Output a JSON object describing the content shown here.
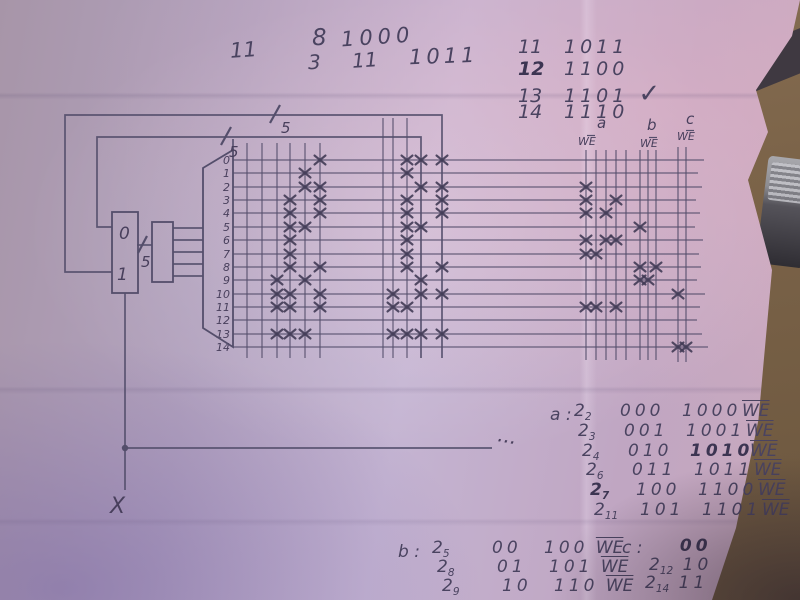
{
  "we_label": "WE",
  "colors": {
    "paper_light": "#c4b4d2",
    "paper_mid": "#b2a2be",
    "paper_dark": "#a795a8",
    "paper_pink": "#caa9bd",
    "ink": "#4a4360",
    "pencil_line": "#585273",
    "table_wood": "#7c6449",
    "corner_shadow": "#3f3941"
  },
  "notes_top": [
    {
      "s": "11",
      "x": 230,
      "y": 40,
      "size": 21
    },
    {
      "s": "8",
      "x": 312,
      "y": 27,
      "size": 23
    },
    {
      "s": "1000",
      "x": 341,
      "y": 27,
      "size": 21,
      "sp": 5
    },
    {
      "s": "3",
      "x": 308,
      "y": 52,
      "size": 20
    },
    {
      "s": "11",
      "x": 352,
      "y": 50,
      "size": 20
    },
    {
      "s": "1011",
      "x": 409,
      "y": 46,
      "size": 21,
      "sp": 4
    }
  ],
  "checklist": {
    "x": 518,
    "y": 38,
    "row_h": 21.5,
    "size": 19,
    "rows": [
      {
        "n": "11",
        "bits": "1011",
        "bold": false,
        "check": false
      },
      {
        "n": "12",
        "bits": "1100",
        "bold": true,
        "check": false
      },
      {
        "n": "13",
        "bits": "1101",
        "bold": false,
        "check": true
      },
      {
        "n": "14",
        "bits": "1110",
        "bold": false,
        "check": false
      }
    ],
    "check_glyph": "✓"
  },
  "table_a": {
    "label": "a :",
    "x": 550,
    "y": 403,
    "row_h": 19.8,
    "drift": 4,
    "size": 17,
    "col_z": 24,
    "col_bits": 70,
    "col_out": 132,
    "col_we": 192,
    "rows": [
      {
        "z": "2",
        "sub": "2",
        "bits": "000",
        "out": "1000",
        "bold_z": false,
        "bold_out": false
      },
      {
        "z": "2",
        "sub": "3",
        "bits": "001",
        "out": "1001",
        "bold_z": false,
        "bold_out": false
      },
      {
        "z": "2",
        "sub": "4",
        "bits": "010",
        "out": "1010",
        "bold_z": false,
        "bold_out": true
      },
      {
        "z": "2",
        "sub": "6",
        "bits": "011",
        "out": "1011",
        "bold_z": false,
        "bold_out": false
      },
      {
        "z": "2",
        "sub": "7",
        "bits": "100",
        "out": "1100",
        "bold_z": true,
        "bold_out": false
      },
      {
        "z": "2",
        "sub": "11",
        "bits": "101",
        "out": "1101",
        "bold_z": false,
        "bold_out": false
      }
    ]
  },
  "table_b": {
    "label": "b :",
    "x": 398,
    "y": 540,
    "row_h": 19,
    "drift": 5,
    "size": 17,
    "col_z": 34,
    "col_bits": 94,
    "col_out": 146,
    "rows": [
      {
        "z": "2",
        "sub": "5",
        "bits": "00",
        "out": "100"
      },
      {
        "z": "2",
        "sub": "8",
        "bits": "01",
        "out": "101"
      },
      {
        "z": "2",
        "sub": "9",
        "bits": "10",
        "out": "110"
      }
    ]
  },
  "table_c": {
    "label": "c :",
    "x": 622,
    "y": 538,
    "size": 17,
    "rows": [
      {
        "z": "",
        "sub": "",
        "bits": "00",
        "dx": 48,
        "dy": 0,
        "bold": true
      },
      {
        "z": "2",
        "sub": "12",
        "bits": "10",
        "dx": 27,
        "dy": 19,
        "bold": false
      },
      {
        "z": "2",
        "sub": "14",
        "bits": "11",
        "dx": 23,
        "dy": 37,
        "bold": false
      }
    ]
  },
  "diagram": {
    "stroke": "#544e6b",
    "row_x1": 233,
    "label_x": 230,
    "rows": [
      {
        "label": "0",
        "y": 160,
        "x2": 704
      },
      {
        "label": "1",
        "y": 173,
        "x2": 698
      },
      {
        "label": "2",
        "y": 187,
        "x2": 702
      },
      {
        "label": "3",
        "y": 200,
        "x2": 696
      },
      {
        "label": "4",
        "y": 213,
        "x2": 700
      },
      {
        "label": "5",
        "y": 227,
        "x2": 695
      },
      {
        "label": "6",
        "y": 240,
        "x2": 703
      },
      {
        "label": "7",
        "y": 254,
        "x2": 699
      },
      {
        "label": "8",
        "y": 267,
        "x2": 701
      },
      {
        "label": "9",
        "y": 280,
        "x2": 697
      },
      {
        "label": "10",
        "y": 294,
        "x2": 705
      },
      {
        "label": "11",
        "y": 307,
        "x2": 700
      },
      {
        "label": "12",
        "y": 320,
        "x2": 697
      },
      {
        "label": "13",
        "y": 334,
        "x2": 702
      },
      {
        "label": "14",
        "y": 347,
        "x2": 708
      }
    ],
    "col_groups": [
      {
        "name": "matrix-left",
        "xs": [
          247,
          262,
          277,
          290,
          305,
          320
        ],
        "y1": 143,
        "y2": 358
      },
      {
        "name": "matrix-mid",
        "xs": [
          383,
          393,
          407
        ],
        "y1": 118,
        "y2": 358
      },
      {
        "name": "bank-a",
        "xs": [
          586,
          596,
          606,
          616,
          626
        ],
        "y1": 150,
        "y2": 360
      },
      {
        "name": "bank-b",
        "xs": [
          640,
          648,
          656
        ],
        "y1": 150,
        "y2": 360
      },
      {
        "name": "bank-c",
        "xs": [
          678,
          686
        ],
        "y1": 147,
        "y2": 362
      }
    ],
    "group_headers": [
      {
        "letter": "a",
        "lx": 597,
        "ly": 128,
        "wx": 578,
        "wy": 145
      },
      {
        "letter": "b",
        "lx": 647,
        "ly": 130,
        "wx": 640,
        "wy": 147
      },
      {
        "letter": "c",
        "lx": 686,
        "ly": 124,
        "wx": 677,
        "wy": 140
      }
    ],
    "wires": [
      [
        [
          112,
          272
        ],
        [
          65,
          272
        ],
        [
          65,
          115
        ],
        [
          442,
          115
        ],
        [
          442,
          358
        ]
      ],
      [
        [
          112,
          227
        ],
        [
          97,
          227
        ],
        [
          97,
          137
        ],
        [
          421,
          137
        ],
        [
          421,
          358
        ]
      ],
      [
        [
          125,
          293
        ],
        [
          125,
          490
        ]
      ],
      [
        [
          125,
          448
        ],
        [
          492,
          448
        ]
      ],
      [
        [
          137,
          245
        ],
        [
          152,
          245
        ]
      ],
      [
        [
          173,
          228
        ],
        [
          203,
          228
        ]
      ],
      [
        [
          173,
          240
        ],
        [
          203,
          240
        ]
      ],
      [
        [
          173,
          252
        ],
        [
          203,
          252
        ]
      ],
      [
        [
          173,
          264
        ],
        [
          203,
          264
        ]
      ],
      [
        [
          173,
          276
        ],
        [
          203,
          276
        ]
      ],
      [
        [
          233,
          139
        ],
        [
          233,
          150
        ]
      ]
    ],
    "slashes": [
      [
        270,
        123,
        280,
        105
      ],
      [
        221,
        145,
        231,
        127
      ],
      [
        138,
        253,
        147,
        236
      ]
    ],
    "labels": [
      {
        "s": "5",
        "x": 281,
        "y": 133,
        "size": 15
      },
      {
        "s": "5",
        "x": 229,
        "y": 157,
        "size": 15
      },
      {
        "s": "5",
        "x": 141,
        "y": 267,
        "size": 15
      },
      {
        "s": "X",
        "x": 110,
        "y": 513,
        "size": 22
      },
      {
        "s": "...",
        "x": 497,
        "y": 441,
        "size": 20,
        "rot": 10
      }
    ],
    "boxes": {
      "mux": {
        "x": 112,
        "y": 212,
        "w": 26,
        "h": 81,
        "label0": "0",
        "l0x": 119,
        "l0y": 239,
        "label1": "1",
        "l1x": 117,
        "l1y": 280
      },
      "box2": {
        "x": 152,
        "y": 222,
        "w": 21,
        "h": 60
      }
    },
    "decoder_pts": "203,168 233,150 233,347 203,328",
    "junction": {
      "x": 125,
      "y": 448,
      "r": 3.2
    },
    "marks": [
      [
        320,
        160
      ],
      [
        305,
        173
      ],
      [
        305,
        187
      ],
      [
        320,
        187
      ],
      [
        290,
        200
      ],
      [
        320,
        200
      ],
      [
        290,
        213
      ],
      [
        320,
        213
      ],
      [
        290,
        227
      ],
      [
        305,
        227
      ],
      [
        290,
        240
      ],
      [
        290,
        254
      ],
      [
        290,
        267
      ],
      [
        320,
        267
      ],
      [
        277,
        280
      ],
      [
        305,
        280
      ],
      [
        277,
        294
      ],
      [
        290,
        294
      ],
      [
        320,
        294
      ],
      [
        277,
        307
      ],
      [
        290,
        307
      ],
      [
        320,
        307
      ],
      [
        277,
        334
      ],
      [
        290,
        334
      ],
      [
        305,
        334
      ],
      [
        407,
        160
      ],
      [
        421,
        160
      ],
      [
        442,
        160
      ],
      [
        407,
        173
      ],
      [
        421,
        187
      ],
      [
        442,
        187
      ],
      [
        407,
        200
      ],
      [
        442,
        200
      ],
      [
        407,
        213
      ],
      [
        442,
        213
      ],
      [
        407,
        227
      ],
      [
        421,
        227
      ],
      [
        407,
        240
      ],
      [
        407,
        254
      ],
      [
        407,
        267
      ],
      [
        442,
        267
      ],
      [
        421,
        280
      ],
      [
        393,
        294
      ],
      [
        421,
        294
      ],
      [
        442,
        294
      ],
      [
        393,
        307
      ],
      [
        407,
        307
      ],
      [
        393,
        334
      ],
      [
        407,
        334
      ],
      [
        421,
        334
      ],
      [
        442,
        334
      ],
      [
        586,
        187
      ],
      [
        586,
        200
      ],
      [
        616,
        200
      ],
      [
        586,
        213
      ],
      [
        606,
        213
      ],
      [
        586,
        240
      ],
      [
        606,
        240
      ],
      [
        616,
        240
      ],
      [
        586,
        254
      ],
      [
        596,
        254
      ],
      [
        586,
        307
      ],
      [
        596,
        307
      ],
      [
        616,
        307
      ],
      [
        640,
        227
      ],
      [
        640,
        267
      ],
      [
        656,
        267
      ],
      [
        640,
        280
      ],
      [
        648,
        280
      ],
      [
        678,
        294
      ],
      [
        678,
        347
      ],
      [
        686,
        347
      ]
    ]
  }
}
